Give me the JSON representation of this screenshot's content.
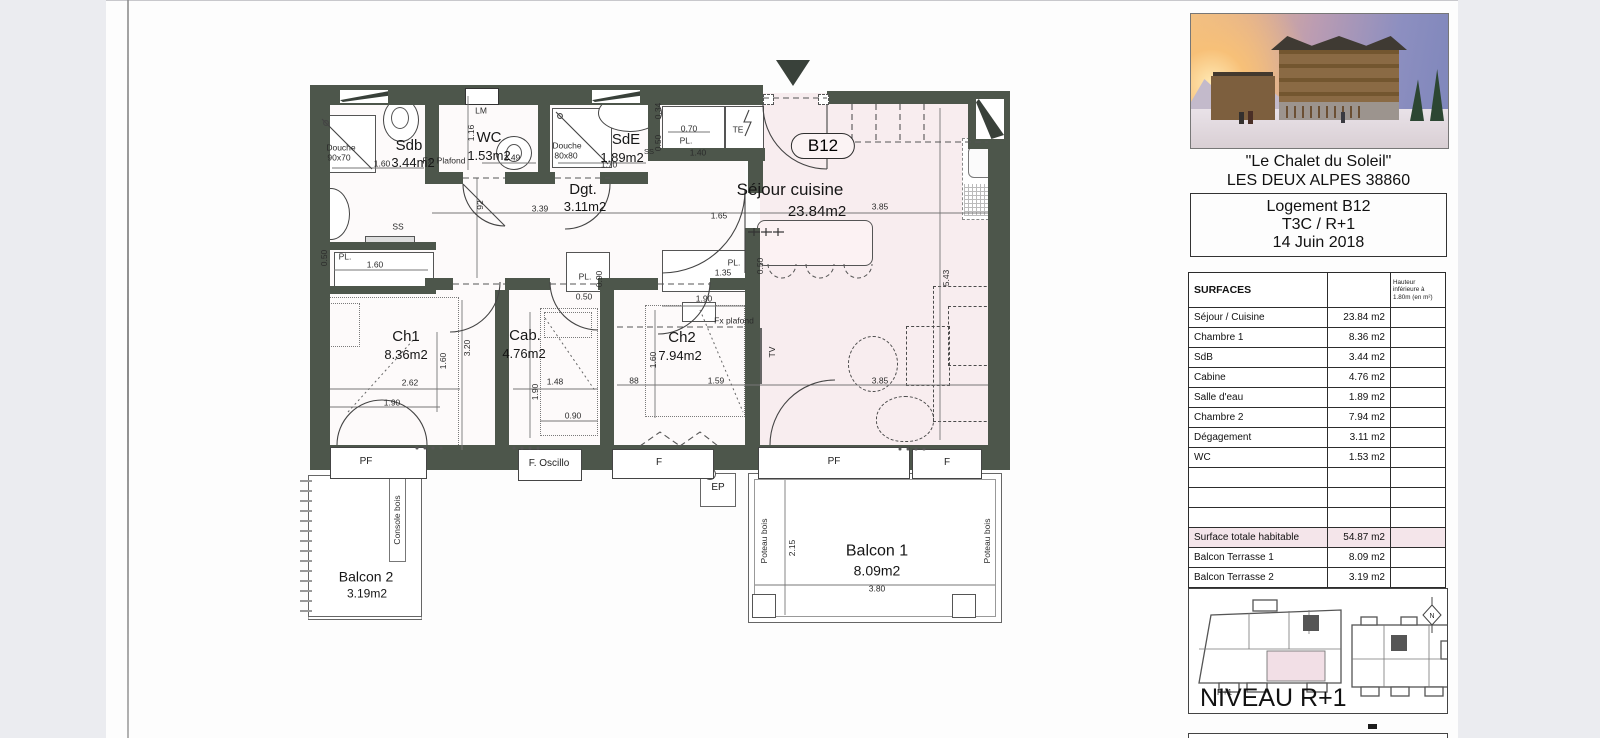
{
  "plan": {
    "unit_badge": "B12",
    "rooms": {
      "sdb": {
        "name": "Sdb",
        "area": "3.44m2"
      },
      "wc": {
        "name": "WC",
        "area": "1.53m2"
      },
      "sde": {
        "name": "SdE",
        "area": "1.89m2"
      },
      "dgt": {
        "name": "Dgt.",
        "area": "3.11m2"
      },
      "sejour": {
        "name": "Séjour cuisine",
        "area": "23.84m2"
      },
      "ch1": {
        "name": "Ch1",
        "area": "8.36m2"
      },
      "cab": {
        "name": "Cab.",
        "area": "4.76m2"
      },
      "ch2": {
        "name": "Ch2",
        "area": "7.94m2"
      },
      "balcon1": {
        "name": "Balcon 1",
        "area": "8.09m2"
      },
      "balcon2": {
        "name": "Balcon 2",
        "area": "3.19m2"
      }
    },
    "fixtures": {
      "douche1": "Douche",
      "douche1_size": "90x70",
      "douche2": "Douche",
      "douche2_size": "80x80",
      "lm": "LM",
      "te": "TE",
      "ss1": "SS",
      "ss2": "SS",
      "ep": "EP",
      "tv": "TV",
      "fx1": "Fx. Plafond",
      "fx2": "Fx plafond",
      "console": "Console bois",
      "poteau": "Poteau bois"
    },
    "windows": [
      "PF",
      "F. Oscillo",
      "F",
      "PF",
      "F"
    ],
    "dims": {
      "sdb_w": "1.60",
      "wc_h": "1.16",
      "wc_w": "1.49",
      "sde_w": "1.70",
      "pl_top_w": "0.70",
      "pl_top_label": "PL.",
      "pl_top_len": "1.40",
      "pl_top_d": "0.50",
      "pl_top_d2": "0.34",
      "dgt_h": "92",
      "dgt_w": "3.39",
      "sej_door": "1.65",
      "sdbpl_d": "0.50",
      "sdbpl_label": "PL.",
      "sdbpl_w": "1.60",
      "ch1_w": "2.62",
      "ch1_bed": "1.90",
      "ch1_d": "1.60",
      "ch1_h": "3.20",
      "cab_w": "1.48",
      "cab_h": "1.90",
      "cab_b": "0.90",
      "cabpl_label": "PL.",
      "cabpl_h": "0.90",
      "cabpl_d": "0.50",
      "ch2_top": "1.90",
      "ch2_d": "1.60",
      "ch2_88": "88",
      "ch2_w": "1.59",
      "ch2pl_label": "PL.",
      "ch2pl_w": "1.35",
      "ch2pl_d": "0.50",
      "sej_w1": "3.85",
      "sej_h": "5.43",
      "sej_w2": "3.85",
      "balc1_h": "2.15",
      "balc1_w": "3.80"
    }
  },
  "panel": {
    "caption1": "\"Le Chalet du Soleil\"",
    "caption2": "LES DEUX ALPES 38860",
    "info": {
      "line1": "Logement B12",
      "line2": "T3C / R+1",
      "line3": "14 Juin 2018"
    },
    "table": {
      "title": "SURFACES",
      "hauteur_note": "Hauteur inférieure à 1.80m (en m²)",
      "rows": [
        {
          "label": "Séjour / Cuisine",
          "value": "23.84 m2"
        },
        {
          "label": "Chambre 1",
          "value": "8.36 m2"
        },
        {
          "label": "SdB",
          "value": "3.44 m2"
        },
        {
          "label": "Cabine",
          "value": "4.76 m2"
        },
        {
          "label": "Salle d'eau",
          "value": "1.89 m2"
        },
        {
          "label": "Chambre 2",
          "value": "7.94 m2"
        },
        {
          "label": "Dégagement",
          "value": "3.11 m2"
        },
        {
          "label": "WC",
          "value": "1.53 m2"
        },
        {
          "label": "",
          "value": ""
        },
        {
          "label": "",
          "value": ""
        },
        {
          "label": "",
          "value": ""
        },
        {
          "label": "Surface totale habitable",
          "value": "54.87 m2"
        },
        {
          "label": "Balcon Terrasse 1",
          "value": "8.09 m2"
        },
        {
          "label": "Balcon Terrasse 2",
          "value": "3.19 m2"
        }
      ]
    },
    "niveau": {
      "title": "NIVEAU R+1",
      "key": "R+1",
      "compass": "N"
    }
  }
}
